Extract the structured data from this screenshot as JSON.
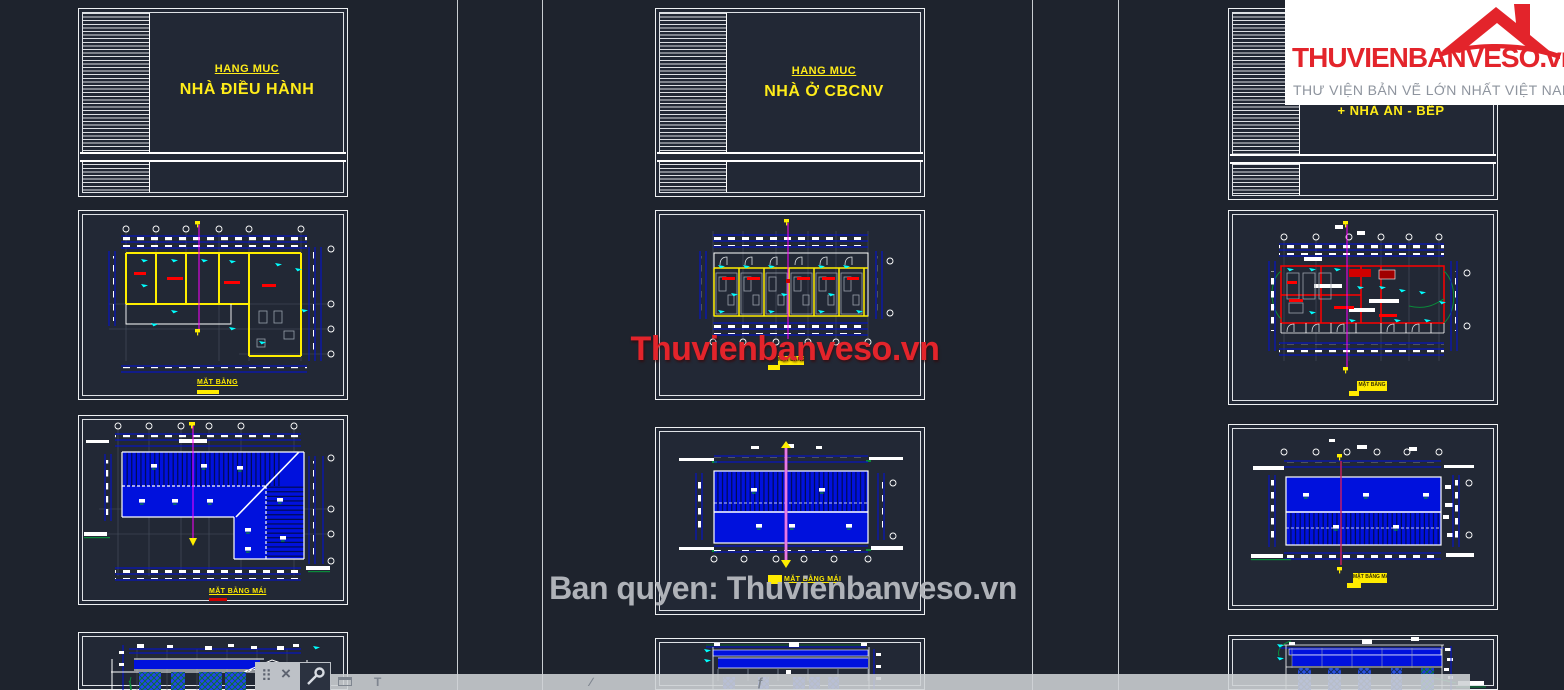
{
  "app": {
    "surface": "cad-model-space",
    "background": "#1e232d"
  },
  "logo": {
    "brand": "THUVIENBANVESO.vn",
    "tagline": "THƯ VIỆN BẢN VẼ LỚN NHẤT VIỆT NAM",
    "brand_color": "#e3242b",
    "tagline_color": "#8e949e"
  },
  "watermarks": {
    "center": "Thuvienbanveso.vn",
    "bottom": "Ban quyen: Thuvienbanveso.vn"
  },
  "columns": {
    "left": {
      "title_heading": "HANG MUC",
      "title_name": "NHÀ ĐIỀU HÀNH",
      "floor_caption": "MẶT BẰNG",
      "roof_caption": "MẶT BẰNG MÁI"
    },
    "middle": {
      "title_heading": "HANG MUC",
      "title_name": "NHÀ Ở CBCNV",
      "floor_caption": "MẶT BẰNG",
      "roof_caption": "MẶT BẰNG MÁI"
    },
    "right": {
      "title_overflow": "+ NHÀ ĂN - BẾP",
      "floor_caption": "MẶT BẰNG",
      "roof_caption": "MẶT BẰNG MÁI"
    }
  },
  "toolbar": {
    "drag_glyph": "⠿",
    "close_glyph": "×",
    "text_tool": "T",
    "slash_tool": "∕",
    "fn_tool": "ƒ"
  },
  "palette": {
    "dim_blue": "#0011dd",
    "wall_yellow": "#ffee00",
    "wall_red": "#ff0000",
    "mark_cyan": "#00ffff",
    "section_magenta": "#ff00ff"
  }
}
